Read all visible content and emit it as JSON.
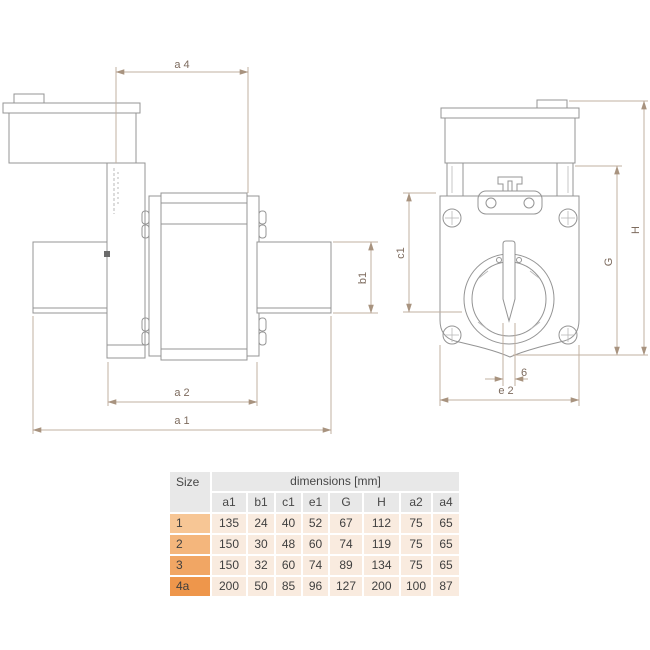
{
  "drawing": {
    "labels": {
      "a4": "a 4",
      "b1": "b1",
      "a2": "a 2",
      "a1": "a 1",
      "c1": "c1",
      "G": "G",
      "H": "H",
      "blade_width": "6",
      "e2": "e 2"
    },
    "colors": {
      "part_outline": "#949494",
      "dimension_line": "#c2b0a1",
      "dimension_label": "#7d6b5e"
    }
  },
  "table": {
    "size_header": "Size",
    "dimensions_header": "dimensions [mm]",
    "columns": [
      "a1",
      "b1",
      "c1",
      "e1",
      "G",
      "H",
      "a2",
      "a4"
    ],
    "rows": [
      {
        "size": "1",
        "values": [
          "135",
          "24",
          "40",
          "52",
          "67",
          "112",
          "75",
          "65"
        ]
      },
      {
        "size": "2",
        "values": [
          "150",
          "30",
          "48",
          "60",
          "74",
          "119",
          "75",
          "65"
        ]
      },
      {
        "size": "3",
        "values": [
          "150",
          "32",
          "60",
          "74",
          "89",
          "134",
          "75",
          "65"
        ]
      },
      {
        "size": "4a",
        "values": [
          "200",
          "50",
          "85",
          "96",
          "127",
          "200",
          "100",
          "87"
        ]
      }
    ],
    "colors": {
      "header_bg": "#e8e8e8",
      "data_cell_bg": "#f9ebdf",
      "size_cell_bgs": [
        "#f7c695",
        "#f4b67c",
        "#f1a664",
        "#ee964b"
      ],
      "text": "#3f3f3f"
    }
  }
}
